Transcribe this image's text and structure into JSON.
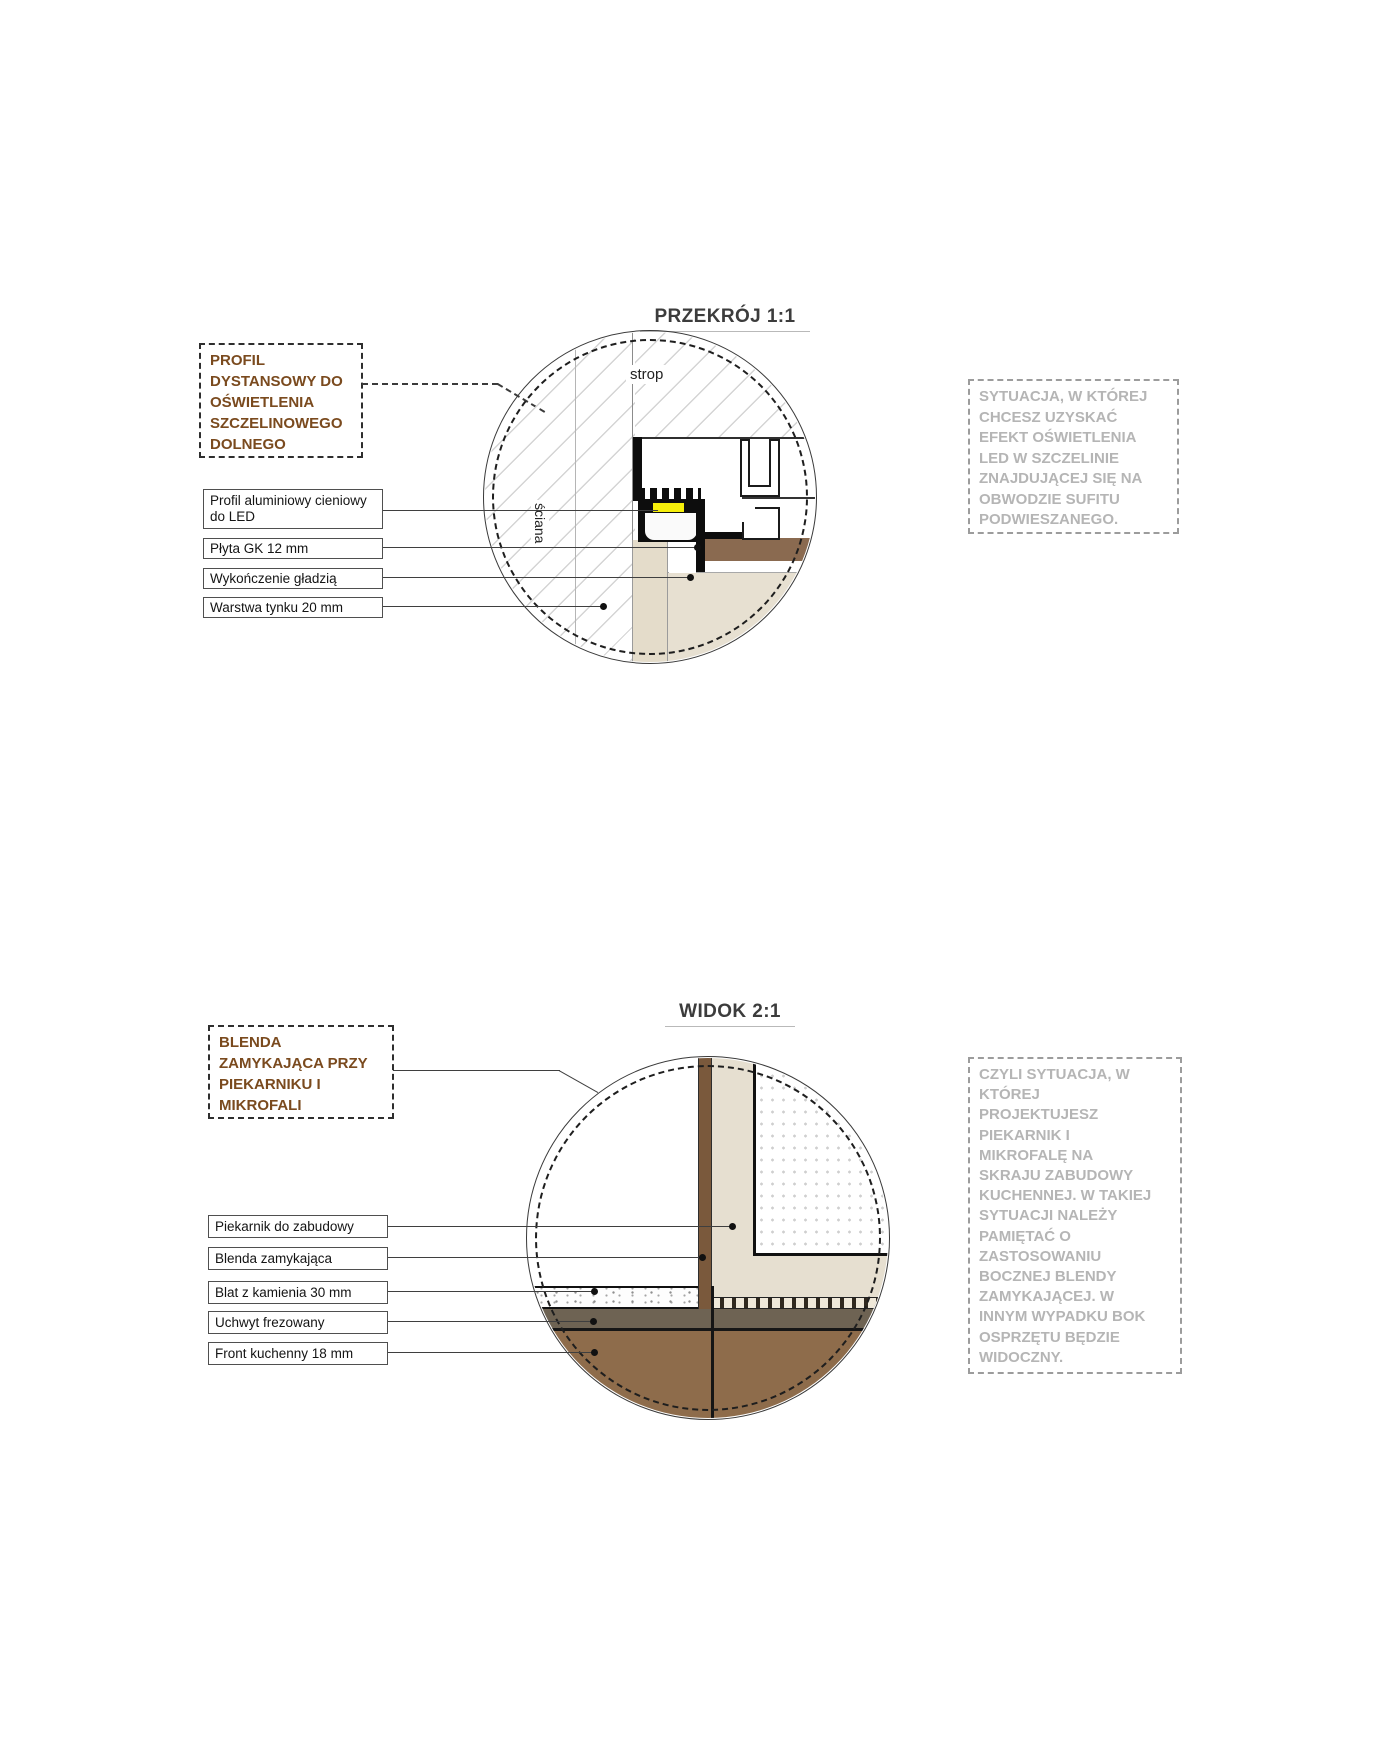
{
  "sections": [
    {
      "title": "PRZEKRÓJ 1:1",
      "callout": "PROFIL\nDYSTANSOWY DO\nOŚWIETLENIA\nSZCZELINOWEGO\nDOLNEGO",
      "labels": [
        "Profil aluminiowy cieniowy\ndo LED",
        "Płyta GK 12 mm",
        "Wykończenie gładzią",
        "Warstwa tynku 20 mm"
      ],
      "annotations": {
        "ceiling": "strop",
        "wall": "ściana"
      },
      "note": "SYTUACJA, W KTÓREJ\nCHCESZ UZYSKAĆ\nEFEKT OŚWIETLENIA\nLED W SZCZELINIE\nZNAJDUJĄCEJ SIĘ NA\nOBWODZIE SUFITU\nPODWIESZANEGO."
    },
    {
      "title": "WIDOK 2:1",
      "callout": "BLENDA\nZAMYKAJĄCA PRZY\nPIEKARNIKU I\nMIKROFALI",
      "labels": [
        "Piekarnik do zabudowy",
        "Blenda zamykająca",
        "Blat z kamienia 30 mm",
        "Uchwyt frezowany",
        "Front kuchenny 18 mm"
      ],
      "note": "CZYLI SYTUACJA, W\nKTÓREJ\nPROJEKTUJESZ\nPIEKARNIK I\nMIKROFALĘ NA\nSKRAJU ZABUDOWY\nKUCHENNEJ. W TAKIEJ\nSYTUACJI NALEŻY\nPAMIĘTAĆ O\nZASTOSOWANIU\nBOCZNEJ BLENDY\nZAMYKAJĄCEJ. W\nINNYM WYPADKU BOK\nOSPRZĘTU BĘDZIE\nWIDOCZNY."
    }
  ],
  "colors": {
    "callout_text": "#7a4a1e",
    "note_text": "#b5b5b5",
    "gk_band_brown": "#8a6a50",
    "blenda_strip_brown": "#7a593c",
    "kitchen_front_brown": "#8e6c4b",
    "milled_handle_band": "#6e6353",
    "plaster_beige": "#e6dfd0",
    "led_yellow": "#f6ef0a"
  }
}
